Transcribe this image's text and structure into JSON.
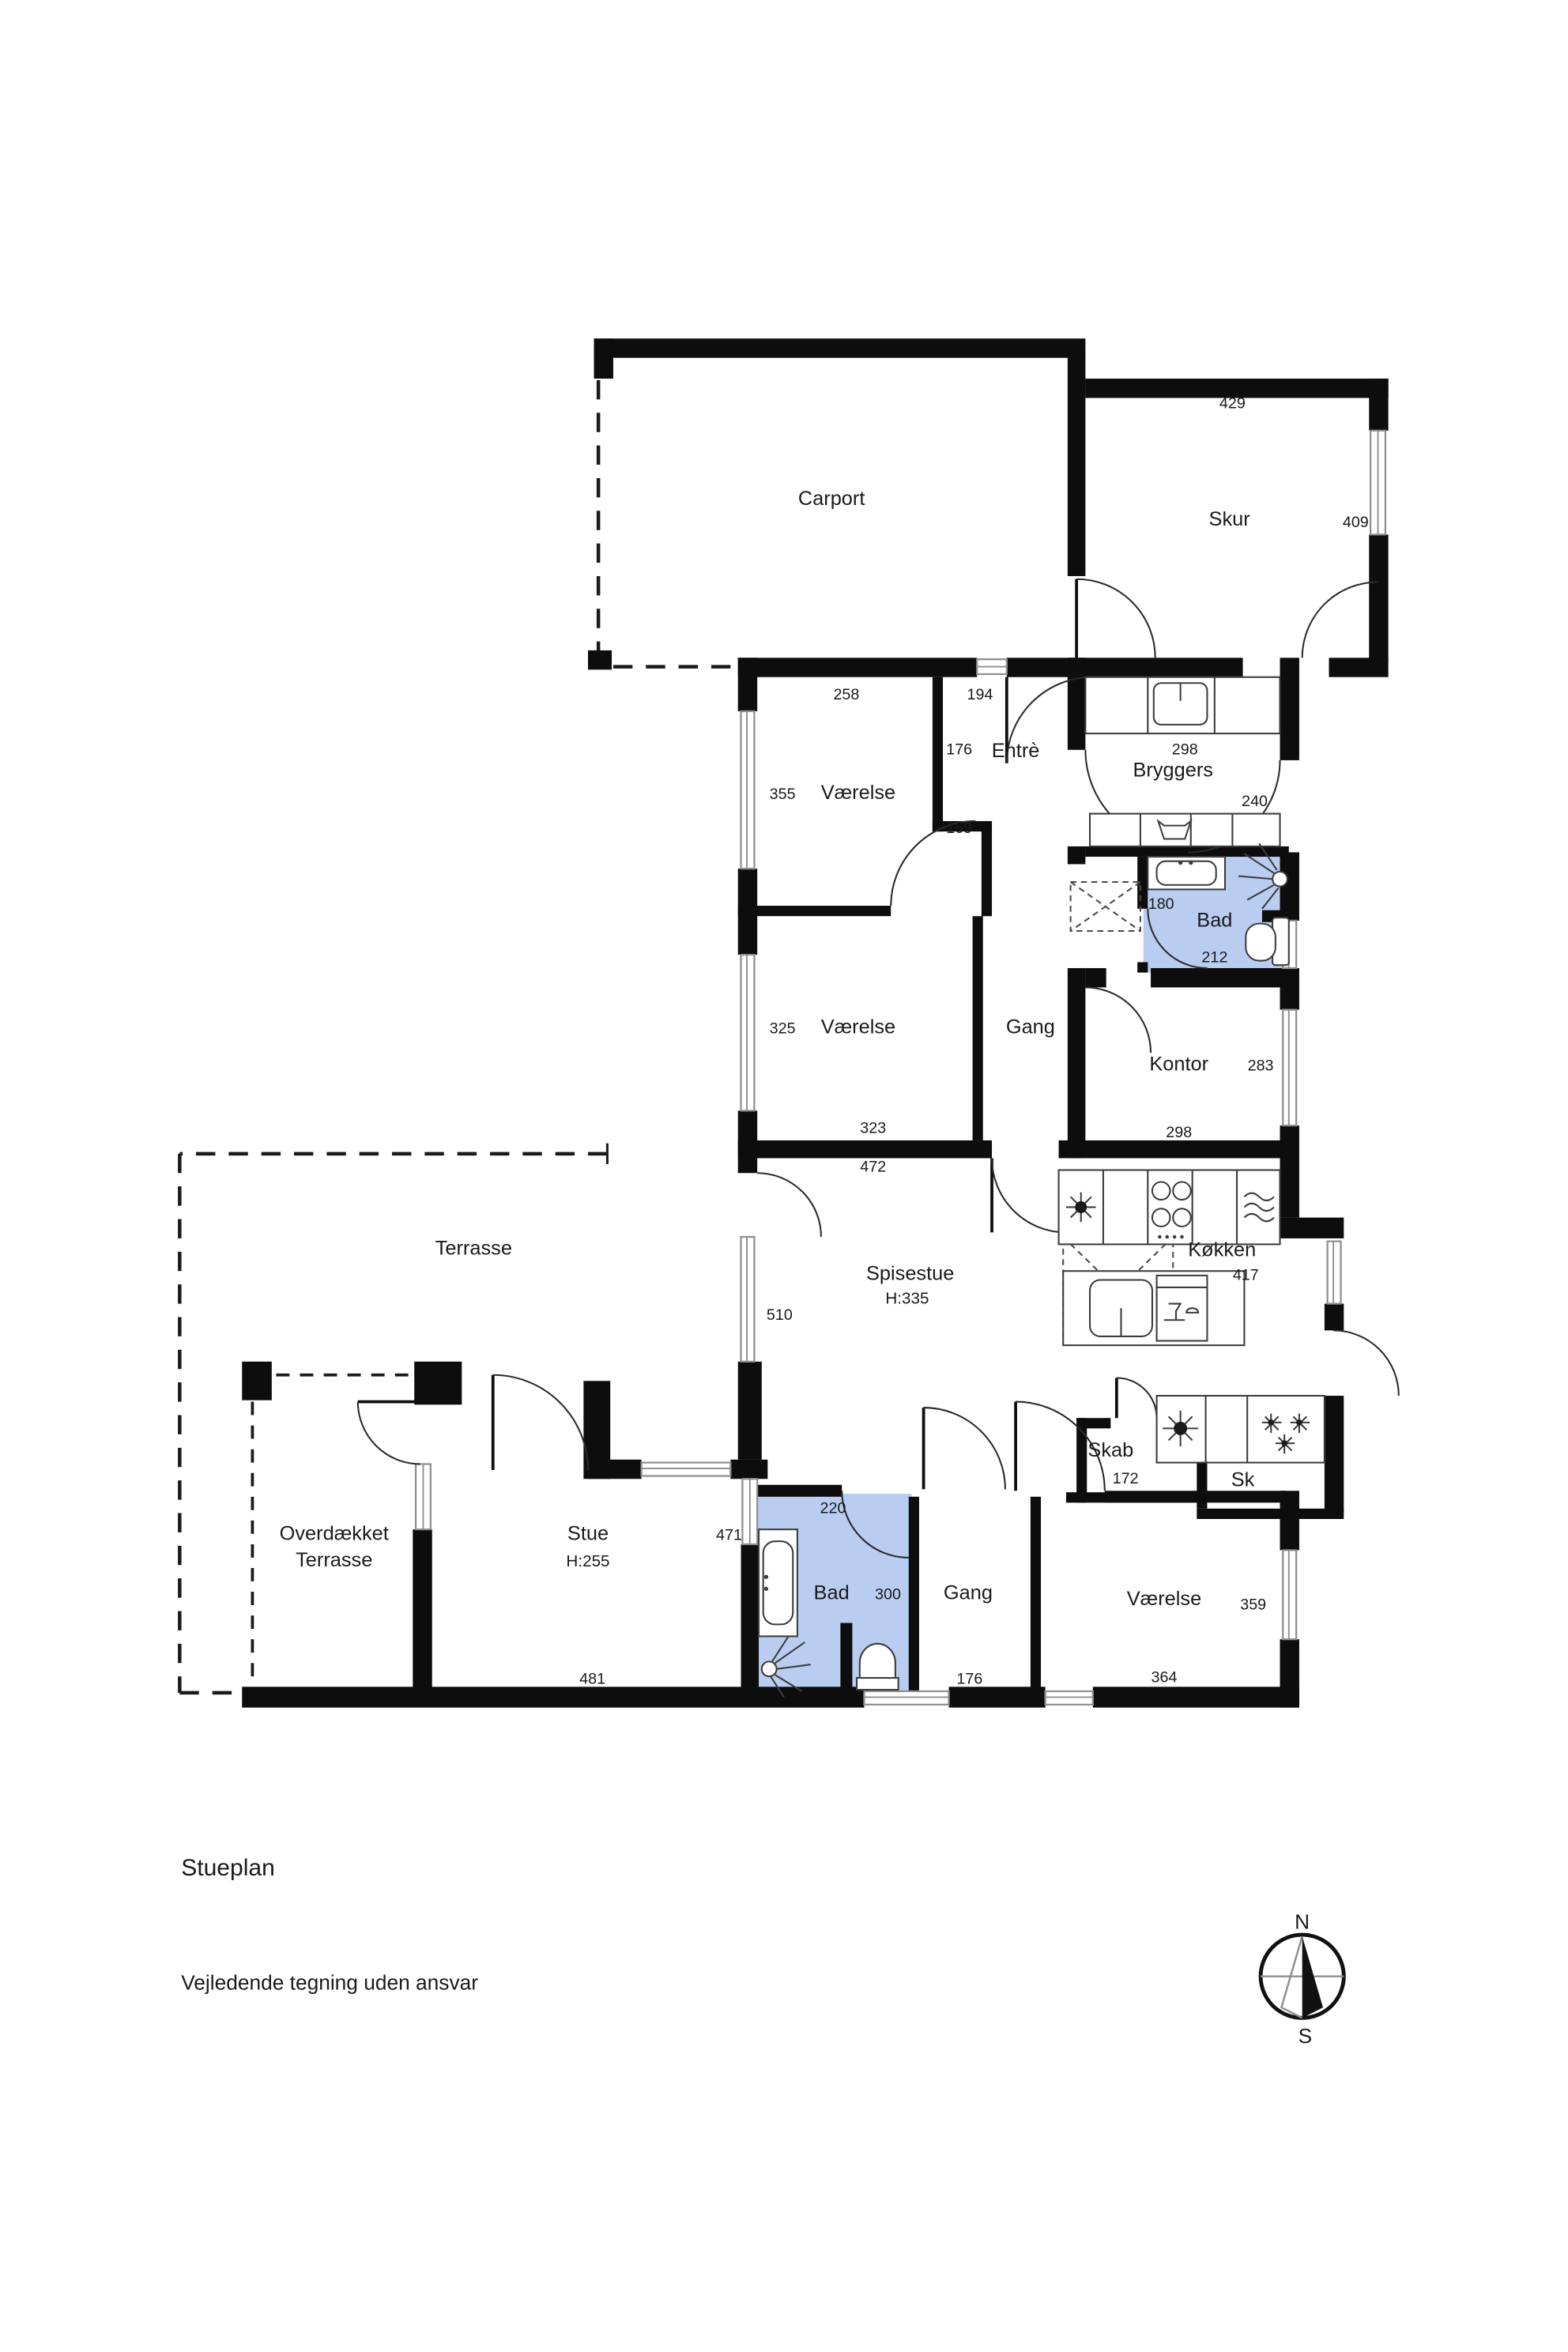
{
  "plan": {
    "title": "Stueplan",
    "disclaimer": "Vejledende tegning uden ansvar",
    "accent_room_color": "#b9cdf1",
    "wall_color": "#0d0d0d"
  },
  "compass": {
    "north": "N",
    "south": "S"
  },
  "rooms": [
    {
      "id": "carport",
      "label": "Carport"
    },
    {
      "id": "skur",
      "label": "Skur"
    },
    {
      "id": "vaerelse-nord",
      "label": "Værelse"
    },
    {
      "id": "entre",
      "label": "Entrè"
    },
    {
      "id": "bryggers",
      "label": "Bryggers"
    },
    {
      "id": "bad-1",
      "label": "Bad"
    },
    {
      "id": "vaerelse-vest",
      "label": "Værelse"
    },
    {
      "id": "gang-1",
      "label": "Gang"
    },
    {
      "id": "kontor",
      "label": "Kontor"
    },
    {
      "id": "terrasse",
      "label": "Terrasse"
    },
    {
      "id": "spisestue",
      "label": "Spisestue",
      "sublabel": "H:335"
    },
    {
      "id": "kokken",
      "label": "Køkken"
    },
    {
      "id": "skab",
      "label": "Skab"
    },
    {
      "id": "sk",
      "label": "Sk"
    },
    {
      "id": "overdaekket",
      "label": "Overdækket",
      "label2": "Terrasse"
    },
    {
      "id": "stue",
      "label": "Stue",
      "sublabel": "H:255"
    },
    {
      "id": "bad-2",
      "label": "Bad"
    },
    {
      "id": "gang-2",
      "label": "Gang"
    },
    {
      "id": "vaerelse-syd",
      "label": "Værelse"
    }
  ],
  "dims": {
    "skur_top": "429",
    "skur_side": "409",
    "vaerelse_n_top": "258",
    "entre_top": "194",
    "entre_side": "176",
    "vaerelse_n_side": "355",
    "notch": "169",
    "bryggers_top": "298",
    "bryggers_side": "240",
    "bad1_top": "180",
    "bad1_bottom": "212",
    "vaerelse_w_side": "325",
    "kontor_side": "283",
    "vaerelse_w_bottom": "323",
    "span_472": "472",
    "kontor_bottom": "298",
    "spisestue_side": "510",
    "kokken_side": "417",
    "skab_bottom": "172",
    "stue_side": "471",
    "bad2_top": "220",
    "bad2_side": "300",
    "vaerelse_s_side": "359",
    "stue_bottom": "481",
    "gang2_bottom": "176",
    "vaerelse_s_bottom": "364"
  }
}
